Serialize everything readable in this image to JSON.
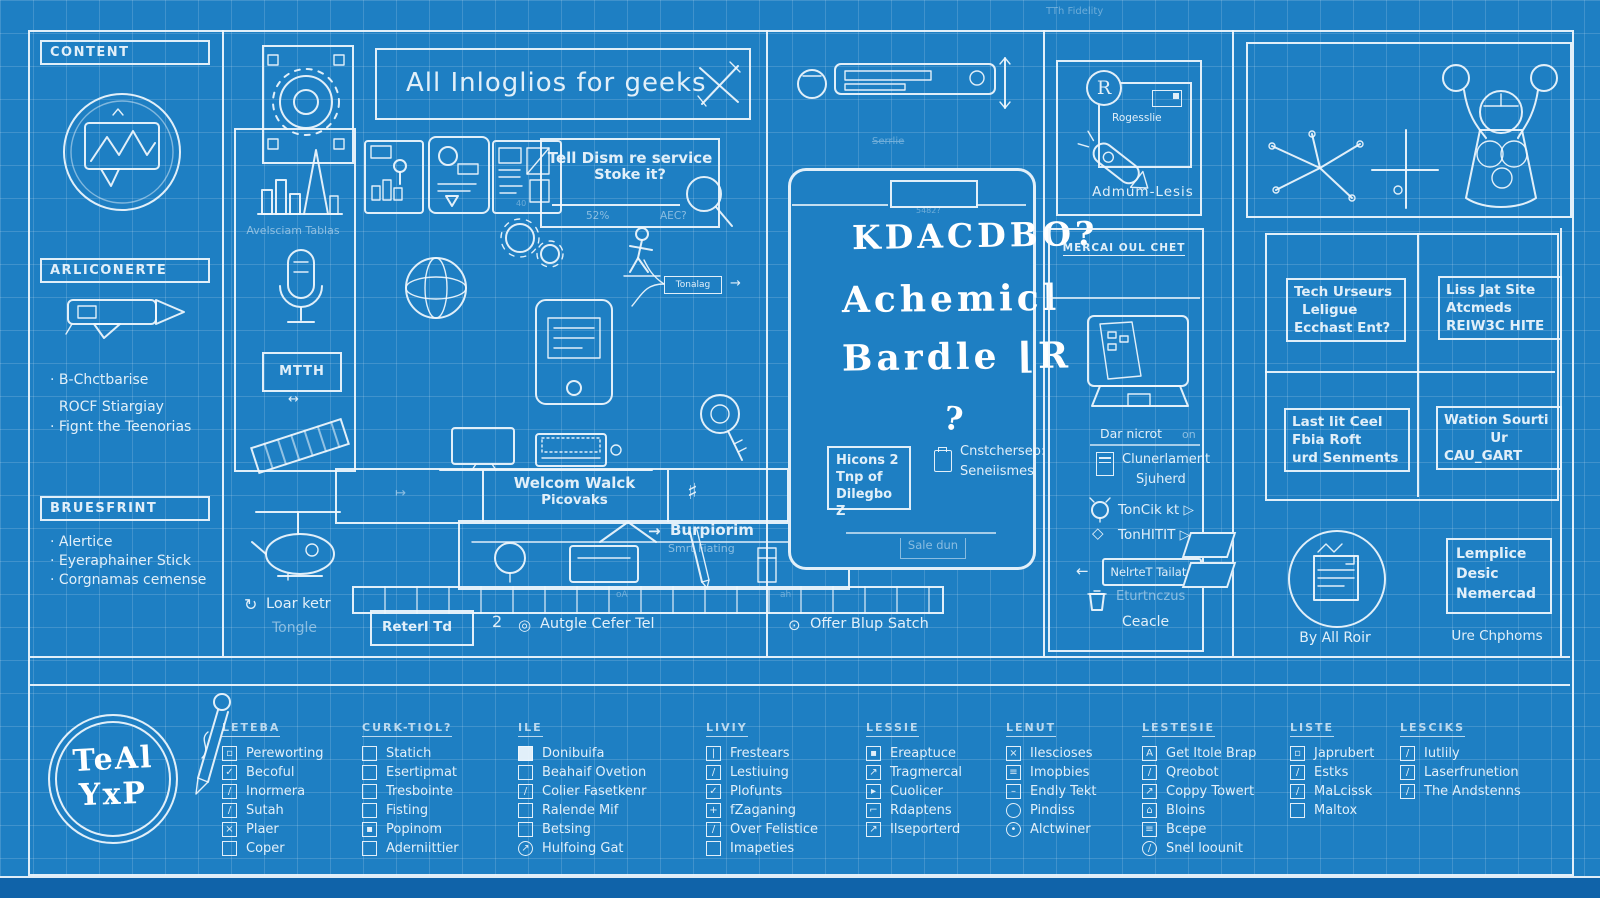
{
  "meta": {
    "fidelity_note": "TTh Fidelity"
  },
  "colors": {
    "bg": "#1e7fc3",
    "line": "#f0f8fd",
    "dark_strip": "#1063a9"
  },
  "header": {
    "title": "All Inloglios for geeks"
  },
  "survey": {
    "line1": "Tell Dism re service",
    "line2": "Stoke it?",
    "pct": "52%",
    "code": "AEC?",
    "tiny": "40"
  },
  "sidebar": {
    "content_title": "CONTENT",
    "section2_title": "ARLICONERTE",
    "section2_items": [
      "B-Chctbarise",
      "ROCF Stiargiay",
      "Fignt the Teenorias"
    ],
    "section3_title": "BRUESFRINT",
    "section3_items": [
      "Alertice",
      "Eyeraphainer Stick",
      "Corgnamas cemense"
    ]
  },
  "iconstrip": {
    "chart_label": "Avelsciam Tablas",
    "mtth": "MTTH",
    "arrows": "↔",
    "loar_icon": "↻",
    "loar": "Loar ketr",
    "tongle": "Tongle"
  },
  "stage": {
    "ribbon_line1": "Welcom Walck",
    "ribbon_line2": "Picovaks",
    "ribbon_mark": "♯",
    "ribbon_tick": "↦",
    "tonalag": "Tonalag",
    "tonalag_arrow": "→",
    "burp_arrow": "→",
    "burpiorim": "Burpiorim",
    "burp_sub": "Smrt Fiating",
    "step_mark1": "oA",
    "step_mark2": "ah",
    "reterl": "Reterl Td",
    "reterl_num": "2",
    "autgle_icon": "◎",
    "autgle": "Autgle Cefer Tel",
    "offer_icon": "⊙",
    "offer": "Offer Blup Satch"
  },
  "phone": {
    "serrlie": "Serrlie",
    "tab_note": "5482?",
    "big_lines": [
      "KDACDBO?",
      "Achemicl",
      "Bardle ⌊R"
    ],
    "box_lines": [
      "Hicons 2",
      "Tnp of",
      "Dilegbo Z"
    ],
    "question_mark": "?",
    "note1": "Cnstchersep:",
    "note2": "Seneiismes",
    "sale": "Sale dun"
  },
  "admin": {
    "r_mark": "R",
    "window_label": "Rogesslie",
    "caption": "Admum-Lesis"
  },
  "media": {
    "header": "MERCAI OUL CHET",
    "dar": "Dar nicrot",
    "on": "on",
    "item1a": "Clunerlament",
    "item1b": "Sjuherd",
    "item2": "TonCik kt ▷",
    "item2_icon": "◌",
    "item3": "TonHITIT ▷",
    "item3_icon": "◇",
    "back_arrow": "←",
    "button": "NelrteT Tailatu",
    "footer1": "Eturtnczus",
    "footer2": "Ceacle"
  },
  "rightgrid": {
    "boxes": [
      {
        "lines": [
          "Tech Urseurs",
          "Leligue",
          "Ecchast Ent?"
        ]
      },
      {
        "lines": [
          "Liss Jat Site",
          "Atcmeds",
          "REIW3C HITE"
        ]
      },
      {
        "lines": [
          "Last Iit Ceel",
          "Fbia Roft",
          "urd Senments"
        ]
      },
      {
        "lines": [
          "Wation Sourti",
          "Ur",
          "CAU_GART"
        ]
      }
    ],
    "by_all": "By All Roir",
    "lemplice": [
      "Lemplice",
      "Desic",
      "Nemercad"
    ],
    "ure": "Ure Chphoms"
  },
  "logo": {
    "line1": "TeAl",
    "line2": "YxP"
  },
  "legend": {
    "columns": [
      {
        "header": "LETEBA",
        "items": [
          {
            "label": "Pereworting",
            "mark": "▫"
          },
          {
            "label": "Becoful",
            "mark": "✓"
          },
          {
            "label": "Inormera",
            "mark": "/"
          },
          {
            "label": "Sutah",
            "mark": "/"
          },
          {
            "label": "Plaer",
            "mark": "×"
          },
          {
            "label": "Coper",
            "mark": ""
          }
        ]
      },
      {
        "header": "CURK-TIOL?",
        "items": [
          {
            "label": "Statich",
            "mark": ""
          },
          {
            "label": "Esertipmat",
            "mark": ""
          },
          {
            "label": "Tresbointe",
            "mark": ""
          },
          {
            "label": "Fisting",
            "mark": ""
          },
          {
            "label": "Popinom",
            "mark": "▪"
          },
          {
            "label": "Aderniittier",
            "mark": ""
          }
        ]
      },
      {
        "header": "ILE",
        "items": [
          {
            "label": "Donibuifa",
            "mark": "",
            "shape": "filled"
          },
          {
            "label": "Beahaif Ovetion",
            "mark": ""
          },
          {
            "label": "Colier Fasetkenr",
            "mark": "/"
          },
          {
            "label": "Ralende Mif",
            "mark": ""
          },
          {
            "label": "Betsing",
            "mark": ""
          },
          {
            "label": "Hulfoing Gat",
            "mark": "↗",
            "shape": "circle"
          }
        ]
      },
      {
        "header": "LIVIY",
        "items": [
          {
            "label": "Frestears",
            "mark": "|"
          },
          {
            "label": "Lestiuing",
            "mark": "/"
          },
          {
            "label": "Plofunts",
            "mark": "✓"
          },
          {
            "label": "fZaganing",
            "mark": "+"
          },
          {
            "label": "Over Felistice",
            "mark": "/"
          },
          {
            "label": "Imapeties",
            "mark": ""
          }
        ]
      },
      {
        "header": "LESSIE",
        "items": [
          {
            "label": "Ereaptuce",
            "mark": "▪"
          },
          {
            "label": "Tragmercal",
            "mark": "↗"
          },
          {
            "label": "Cuolicer",
            "mark": "▸"
          },
          {
            "label": "Rdaptens",
            "mark": "⌐"
          },
          {
            "label": "Ilseporterd",
            "mark": "↗"
          }
        ]
      },
      {
        "header": "LENUT",
        "items": [
          {
            "label": "Ilescioses",
            "mark": "×"
          },
          {
            "label": "Imopbies",
            "mark": "≡"
          },
          {
            "label": "Endly Tekt",
            "mark": "–"
          },
          {
            "label": "Pindiss",
            "mark": "",
            "shape": "circle"
          },
          {
            "label": "Alctwiner",
            "mark": "•",
            "shape": "circle"
          }
        ]
      },
      {
        "header": "LESTESIE",
        "items": [
          {
            "label": "Get Itole Brap",
            "mark": "A"
          },
          {
            "label": "Qreobot",
            "mark": "/"
          },
          {
            "label": "Coppy Towert",
            "mark": "↗"
          },
          {
            "label": "Bloins",
            "mark": "⌂"
          },
          {
            "label": "Bcepe",
            "mark": "≡"
          },
          {
            "label": "Snel loounit",
            "mark": "/",
            "shape": "circle"
          }
        ]
      },
      {
        "header": "LISTE",
        "items": [
          {
            "label": "Japrubert",
            "mark": "▫"
          },
          {
            "label": "Estks",
            "mark": "/"
          },
          {
            "label": "MaLcissk",
            "mark": "/"
          },
          {
            "label": "Maltox",
            "mark": ""
          }
        ]
      },
      {
        "header": "LESCIKS",
        "items": [
          {
            "label": "Iutlily",
            "mark": "/"
          },
          {
            "label": "Laserfrunetion",
            "mark": "/"
          },
          {
            "label": "The Andstenns",
            "mark": "/"
          }
        ]
      }
    ]
  }
}
